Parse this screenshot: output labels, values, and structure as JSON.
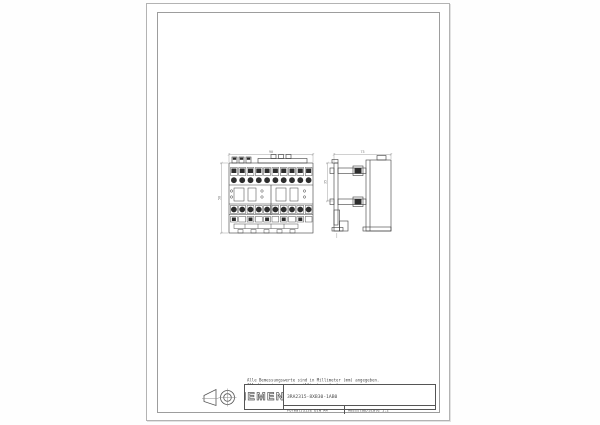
{
  "sheet": {
    "notes": {
      "line1": "Alle Bemessungswerte sind in Millimeter (mm) angegeben.",
      "line2": "All dimensions are in millimeters (mm)"
    },
    "title_block": {
      "brand": "SIEMENS",
      "part_number": "3RA2315-8XB30-1AB0",
      "format_label": "Format/Size DIN A4",
      "scale_label": "Massstab/Scale 1:2"
    },
    "views": {
      "front": {
        "width_dim": "90",
        "height_dim": "58"
      },
      "side": {
        "depth_dim": "73",
        "offset_dim": "35"
      }
    },
    "icons": {
      "projection_symbol": "first-angle-projection"
    },
    "colors": {
      "line": "#3c3c3c",
      "dark_fill": "#2d2d2d",
      "dim_line": "#8a8a8a",
      "frame": "#9d9d9d",
      "paper": "#ffffff"
    }
  }
}
